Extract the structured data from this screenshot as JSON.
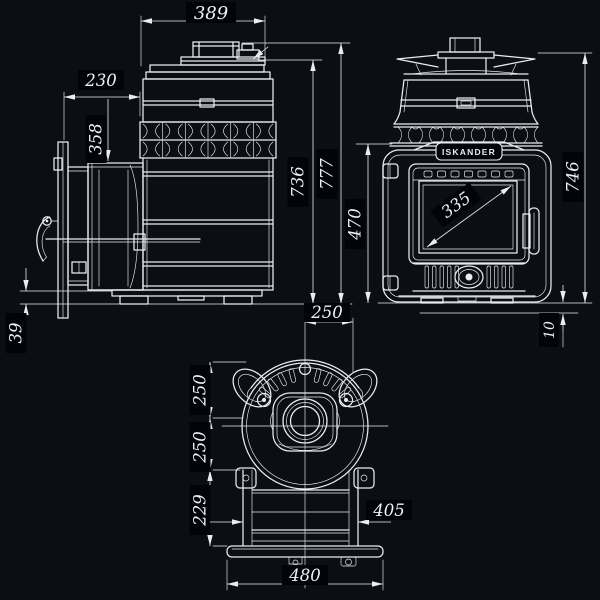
{
  "colors": {
    "background": "#0c0e13",
    "line": "#e9edf3",
    "dim_text": "#eef1f6",
    "label_bg": "#030409"
  },
  "brand": {
    "label": "ISKANDER"
  },
  "views": {
    "side": {
      "dims": {
        "width": "389",
        "tunnel_depth": "230",
        "firebox_height": "358",
        "body_height": "736",
        "overall_height": "777",
        "base_gap": "39"
      }
    },
    "front": {
      "dims": {
        "door_height": "470",
        "glass_diagonal": "335",
        "overall_height": "746",
        "floor_gap": "10"
      }
    },
    "top": {
      "dims": {
        "center_to_edge": "250",
        "front_depth": "250",
        "rear_depth": "250",
        "tunnel_length": "229",
        "tunnel_width": "405",
        "base_width": "480"
      }
    }
  }
}
